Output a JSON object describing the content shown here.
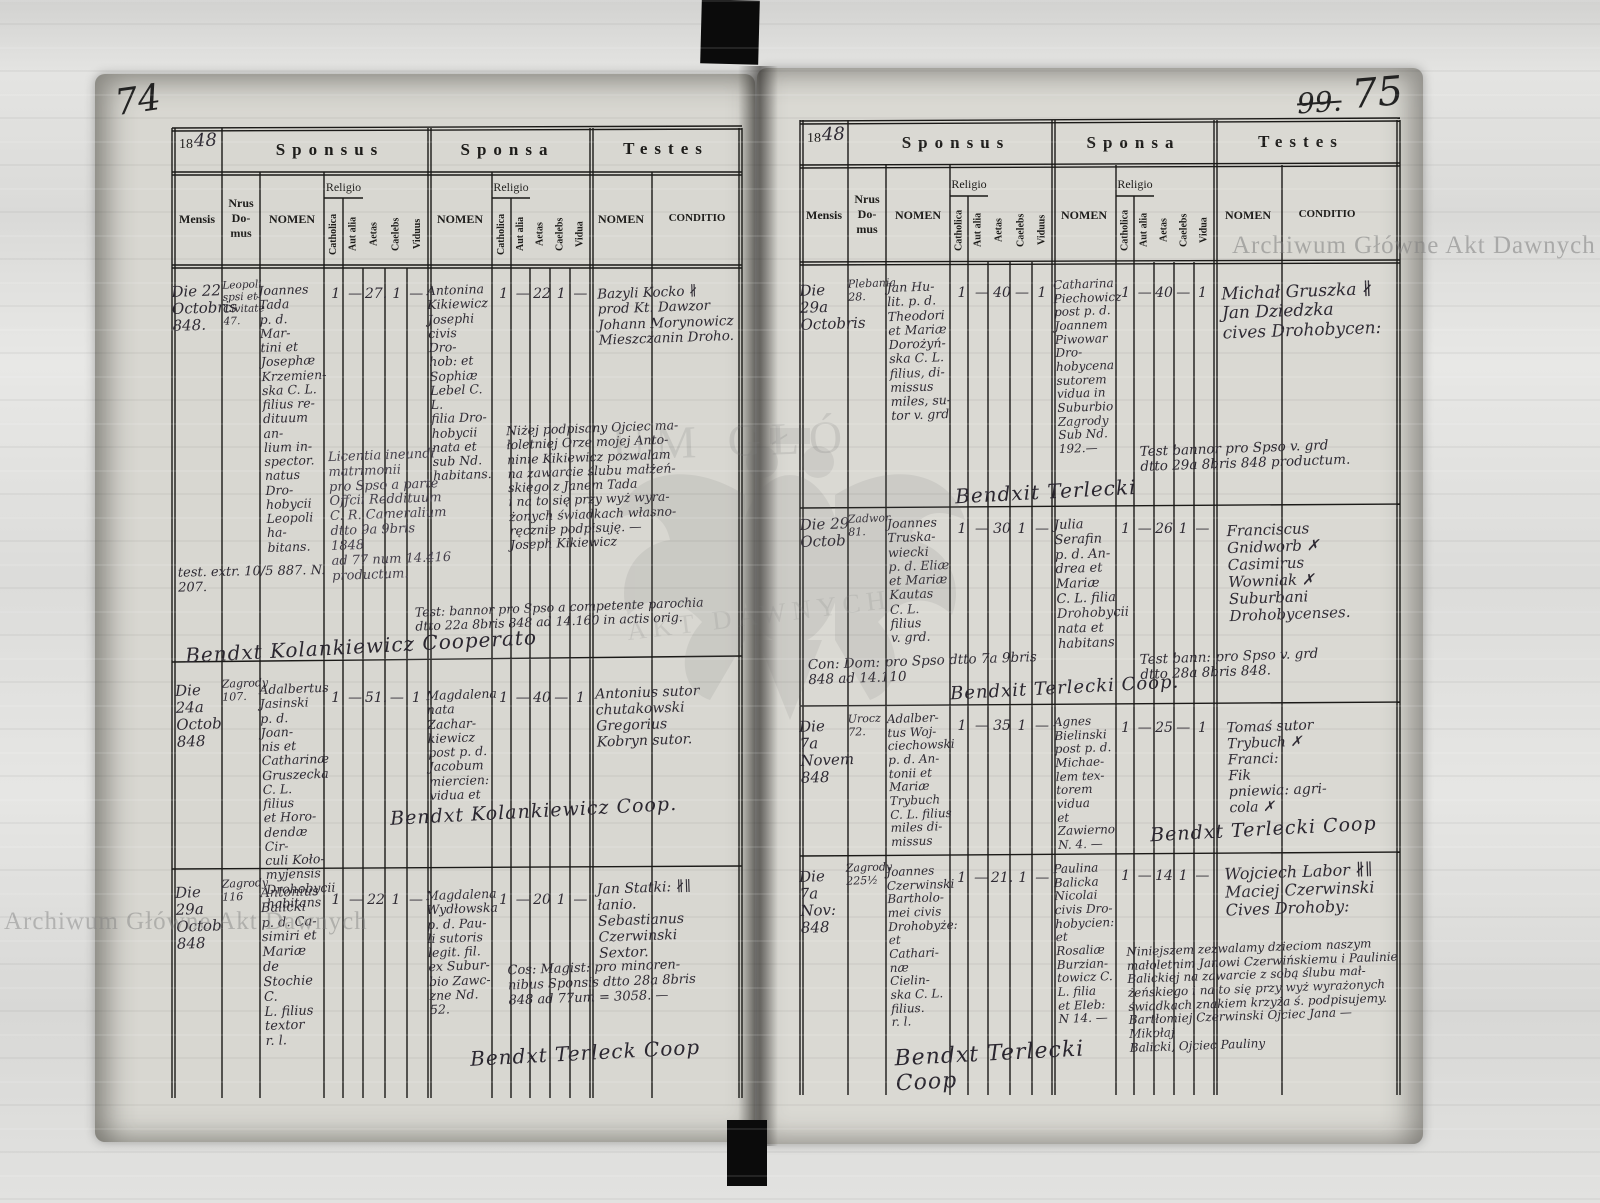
{
  "page_numbers": {
    "left": "74",
    "right_struck": "99.",
    "right": "75"
  },
  "watermarks": {
    "agad_text": "Archiwum Główne Akt Dawnych",
    "fragment_top": "UM GŁÓ",
    "fragment_bottom": "AKT DAWNYCH"
  },
  "headers": {
    "year_prefix": "18",
    "year_hand": "48",
    "sponsus": "Sponsus",
    "sponsa": "Sponsa",
    "testes": "Testes",
    "mensis": "Mensis",
    "nrus_domus": "Nrus\nDo-\nmus",
    "nomen": "NOMEN",
    "religio": "Religio",
    "catholica": "Catholica",
    "aut_alia": "Aut alia",
    "aetas": "Aetas",
    "caelebs": "Caelebs",
    "viduus": "Viduus",
    "vidua": "Vidua",
    "conditio": "CONDITIO"
  },
  "left_page": {
    "rows": [
      {
        "mensis": "Die 22\nOctobris\n848.",
        "nrus": "Leopoli\nspsi et\nCivitate\n47.",
        "sponsus_nomen": "Joannes\nTada\np. d. Mar-\ntini et\nJosephæ\nKrzemien-\nska C. L.\nfilius re-\ndituum an-\nlium in-\nspector.\nnatus Dro-\nhobycii\nLeopoli ha-\nbitans.",
        "sponsus_cath": "1",
        "sponsus_aut": "—",
        "sponsus_aetas": "27.",
        "sponsus_caelebs": "1",
        "sponsus_viduus": "—",
        "sponsa_nomen": "Antonina\nKikiewicz\nJosephi\ncivis Dro-\nhob: et\nSophiæ\nLebel C. L.\nfilia Dro-\nhobycii\nnata et\nsub Nd.\nhabitans.",
        "sponsa_cath": "1",
        "sponsa_aut": "—",
        "sponsa_aetas": "22",
        "sponsa_caelebs": "1",
        "sponsa_vidua": "—",
        "testes": "Bazyli Kocko ∦\nprod Kt. Dawzor\nJohann Morynowicz\nMieszczanin Droho.",
        "notes": {
          "extr": "test. extr. 10/5 887. N. 207.",
          "license": "Licentia ineundi\nmatrimonii\npro Spso a parte\nOffcii Reddituum\nC. R. Cameralium\ndtto 9a 9bris\n1848\nad 77 num 14.416 productum.",
          "polish": "Niżej podpisany Ojciec ma-\nłoletniej Orze mojej Anto-\nninie Kikiewicz pozwalam\nna zawarcie ślubu małżeń-\nskiego z Janem Tada\ni na to się przy wyż wyra-\nżonych świadkach własno-\nręcznie podpisuję. —\nJoseph Kikiewicz",
          "bann": "Test: bannor pro Spso a competente parochia\ndtto 22a 8bris 848 ad 14.160 in actis orig."
        },
        "benedixit": "Bendxt    Kolankiewicz    Cooperato"
      },
      {
        "mensis": "Die\n24a\nOctob\n848",
        "nrus": "Zagrody\n107.",
        "sponsus_nomen": "Adalbertus\nJasinski\np. d. Joan-\nnis et\nCatharinæ\nGruszecka\nC. L. filius\net Horo-\ndendæ Cir-\nculi Koło-\nmyjensis\nDrohobycii\nhabitans",
        "sponsus_cath": "1",
        "sponsus_aut": "—",
        "sponsus_aetas": "51.",
        "sponsus_caelebs": "—",
        "sponsus_viduus": "1",
        "sponsa_nomen": "Magdalena\nnata Zachar-\nkiewicz\npost p. d.\nJacobum\nmiercien:\nvidua et",
        "sponsa_cath": "1",
        "sponsa_aut": "—",
        "sponsa_aetas": "40",
        "sponsa_caelebs": "—",
        "sponsa_vidua": "1",
        "testes": "Antonius  sutor\nchutakowski\nGregorius\nKobryn     sutor.",
        "notes": {},
        "benedixit": "Bendxt    Kolankiewicz   Coop."
      },
      {
        "mensis": "Die\n29a\nOctob\n848",
        "nrus": "Zagrody\n116",
        "sponsus_nomen": "Antonius\nBalicki\np. d. Ca-\nsimiri et\nMariæ de\nStochie C.\nL. filius\ntextor\nr. l.",
        "sponsus_cath": "1",
        "sponsus_aut": "—",
        "sponsus_aetas": "22",
        "sponsus_caelebs": "1",
        "sponsus_viduus": "—",
        "sponsa_nomen": "Magdalena\nWydłowska\np. d. Pau-\nli sutoris\nlegit. fil.\nex Subur-\nbio Zawc-\nzne Nd.\n52.",
        "sponsa_cath": "1",
        "sponsa_aut": "—",
        "sponsa_aetas": "20",
        "sponsa_caelebs": "1",
        "sponsa_vidua": "—",
        "testes": "Jan Statki: ∦∥\nłanio.\nSebastianus\nCzerwinski\nSextor.",
        "notes": {
          "magist": "Cos: Magist: pro minoren-\nnibus Sponsis dtto 28a 8bris\n848 ad 77um = 3058. —"
        },
        "benedixit": "Bendxt  Terleck  Coop"
      }
    ]
  },
  "right_page": {
    "rows": [
      {
        "mensis": "Die\n29a\nOctobris",
        "nrus": "Plebania\n28.",
        "sponsus_nomen": "Jan Hu-\nlit. p. d.\nTheodori\net Mariæ\nDorożyń-\nska C. L.\nfilius, di-\nmissus\nmiles, su-\ntor v. grd",
        "sponsus_cath": "1",
        "sponsus_aut": "—",
        "sponsus_aetas": "40",
        "sponsus_caelebs": "—",
        "sponsus_viduus": "1",
        "sponsa_nomen": "Catharina\nPiechowicz\npost p. d.\nJoannem\nPiwowar Dro-\nhobycena\nsutorem\nvidua in\nSuburbio\nZagrody\nSub Nd.\n192.—",
        "sponsa_cath": "1",
        "sponsa_aut": "—",
        "sponsa_aetas": "40",
        "sponsa_caelebs": "—",
        "sponsa_vidua": "1",
        "testes": "Michał Gruszka ∦\nJan Dziedzka\n      cives Drohobycen:",
        "notes": {
          "bann": "Test bannor pro Spso v. grd\ndtto 29a 8bris 848 productum."
        },
        "benedixit": "Bendxit      Terlecki"
      },
      {
        "mensis": "Die 29\nOctob",
        "nrus": "Zadwor\n81.",
        "sponsus_nomen": "Joannes\nTruska-\nwiecki\np. d. Eliæ\net Mariæ\nKautas\nC. L. filius\nv. grd.",
        "sponsus_cath": "1",
        "sponsus_aut": "—",
        "sponsus_aetas": "30",
        "sponsus_caelebs": "1",
        "sponsus_viduus": "—",
        "sponsa_nomen": "Julia\nSerafin\np. d. An-\ndrea et\nMariæ\nC. L. filia\nDrohobycii\nnata et\nhabitans",
        "sponsa_cath": "1",
        "sponsa_aut": "—",
        "sponsa_aetas": "26",
        "sponsa_caelebs": "1",
        "sponsa_vidua": "—",
        "testes": "Franciscus\nGnidworb ✗\nCasimirus\nWowniak ✗\nSuburbani\nDrohobycenses.",
        "notes": {
          "con_dom": "Con: Dom:   pro Spso   dtto 7a   9bris\n848 ad 14.110",
          "bann": "Test bann: pro Spso v. grd\ndtto 28a 8bris 848."
        },
        "benedixit": "Bendxit       Terlecki    Coop."
      },
      {
        "mensis": "Die\n7a\nNovem\n848",
        "nrus": "Urocz\n72.",
        "sponsus_nomen": "Adalber-\ntus Woj-\nciechowski\np. d. An-\ntonii et\nMariæ\nTrybuch\nC. L. filius\nmiles di-\nmissus",
        "sponsus_cath": "1",
        "sponsus_aut": "—",
        "sponsus_aetas": "35",
        "sponsus_caelebs": "1",
        "sponsus_viduus": "—",
        "sponsa_nomen": "Agnes\nBielinski\npost p. d.\nMichae-\nlem tex-\ntorem\nvidua\net Zawierno\nN. 4. —",
        "sponsa_cath": "1",
        "sponsa_aut": "—",
        "sponsa_aetas": "25",
        "sponsa_caelebs": "—",
        "sponsa_vidua": "1",
        "testes": "Tomaś       sutor\nTrybuch ✗\nFranci:\nFik\npniewia:    agri-\ncola ✗",
        "notes": {},
        "benedixit": "Bendxt  Terlecki  Coop"
      },
      {
        "mensis": "Die\n7a Nov:\n848",
        "nrus": "Zagrody\n225½",
        "sponsus_nomen": "Joannes\nCzerwinski\nBartholo-\nmei civis\nDrohobyże:\net Cathari-\nnæ Cielin-\nska C. L.\nfilius.\nr. l.",
        "sponsus_cath": "1",
        "sponsus_aut": "—",
        "sponsus_aetas": "21.",
        "sponsus_caelebs": "1",
        "sponsus_viduus": "—",
        "sponsa_nomen": "Paulina\nBalicka\nNicolai\ncivis Dro-\nhobycien:\net Rosaliæ\nBurzian-\ntowicz C.\nL. filia\net Eleb:\nN 14. —",
        "sponsa_cath": "1",
        "sponsa_aut": "—",
        "sponsa_aetas": "14",
        "sponsa_caelebs": "1",
        "sponsa_vidua": "—",
        "testes": "Wojciech Labor ∦∥\nMaciej Czerwinski\n     Cives Drohoby:",
        "notes": {
          "polish": "Niniejszem zezwalamy dzieciom naszym\nmałoletnim Janowi Czerwińskiemu i Paulinie\nBalickiej na zawarcie z sobą ślubu mał-\nżeńskiego i na to się przy wyż wyrażonych\nświadkach znakiem krzyża ś. podpisujemy.\nBartłomiej Czerwinski Ojciec Jana —\n            Mikołaj\nBalicki, Ojciec Pauliny"
        },
        "benedixit": "Bendxt  Terlecki\n            Coop"
      }
    ]
  }
}
